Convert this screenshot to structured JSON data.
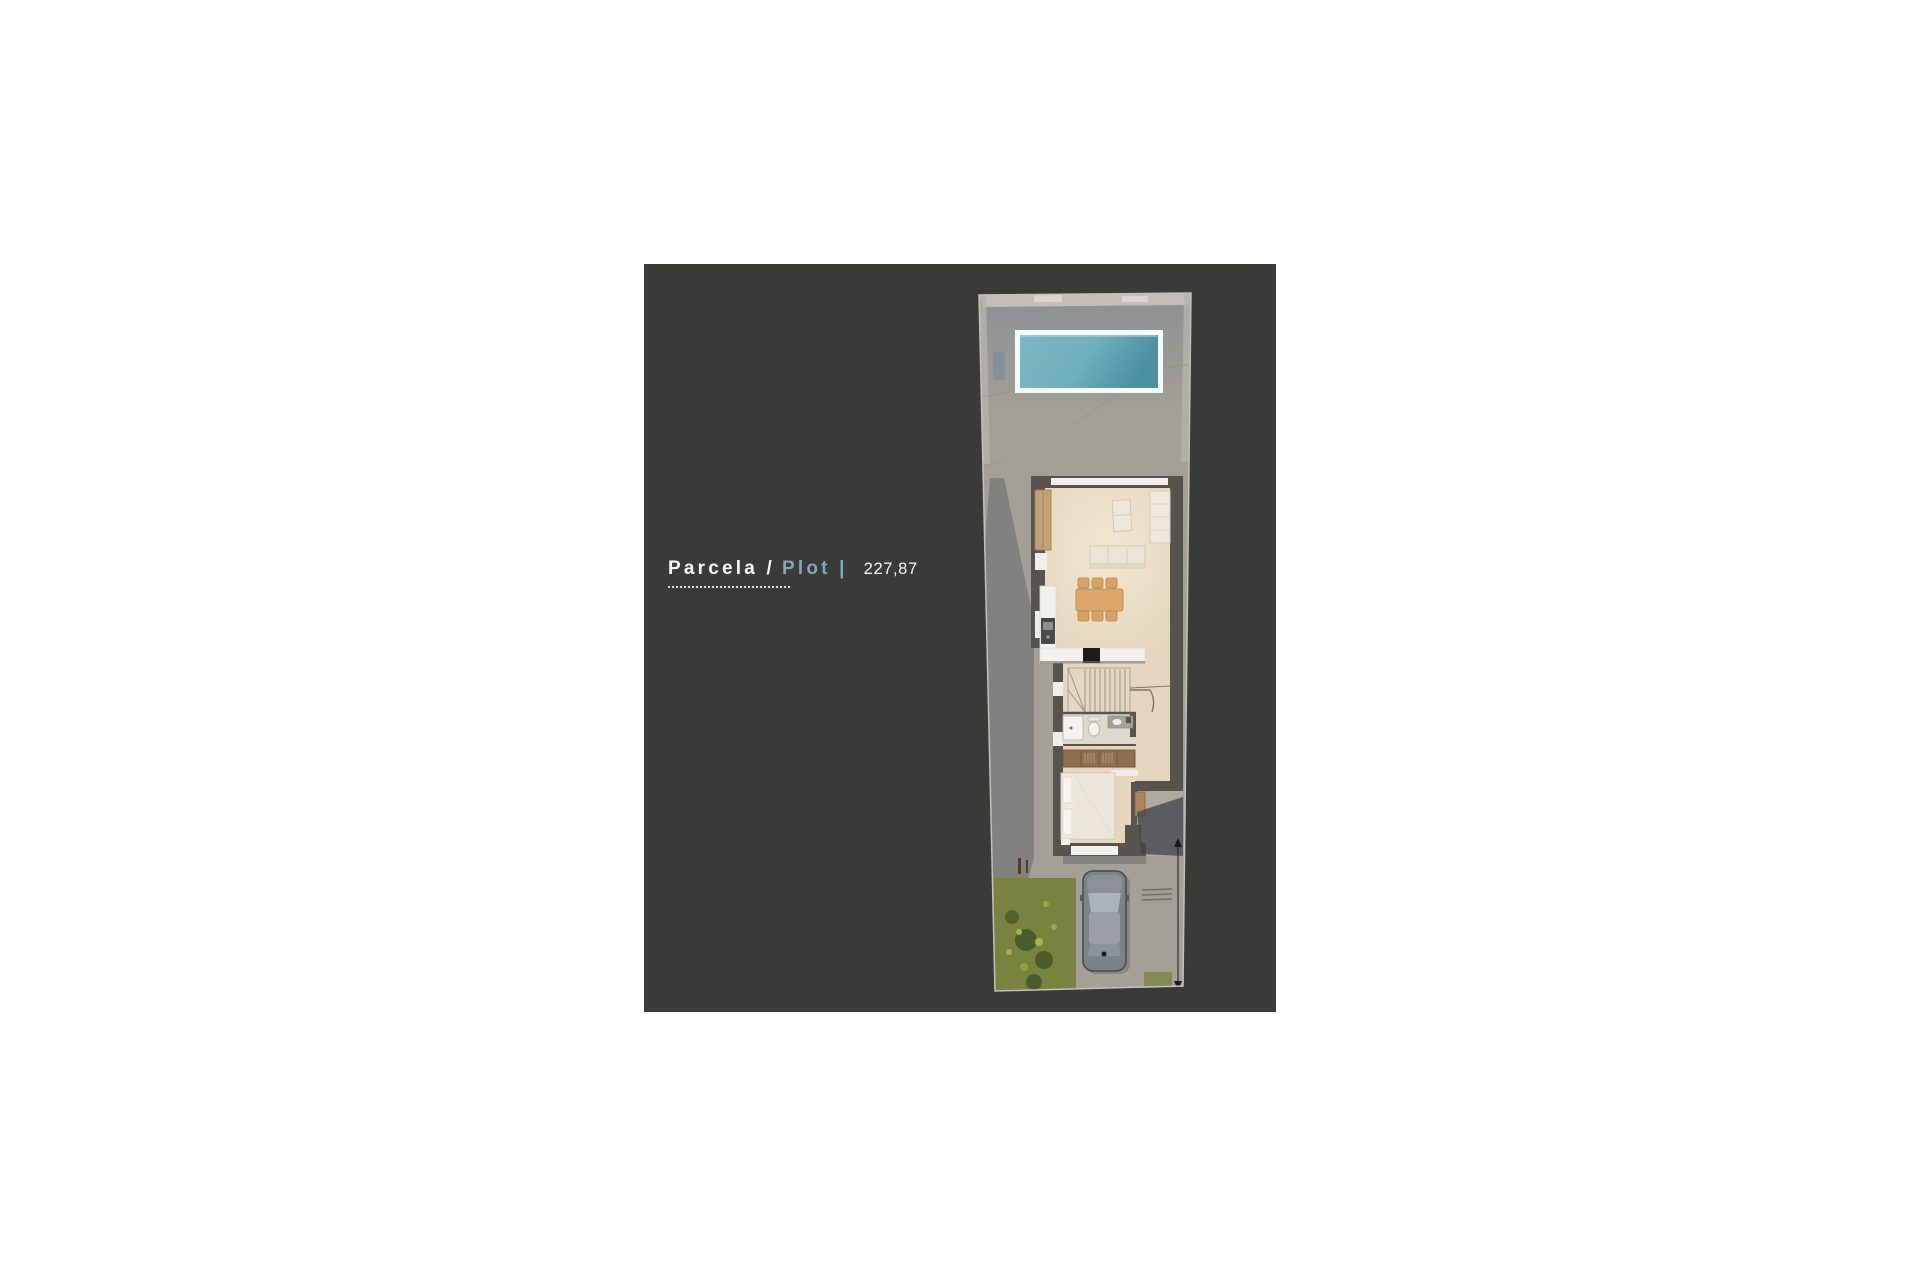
{
  "panel": {
    "background": "#3a3a38"
  },
  "label": {
    "primary": "Parcela /",
    "secondary": "Plot |",
    "value": "227,87"
  },
  "colors": {
    "page_bg": "#ffffff",
    "panel_bg": "#3a3a38",
    "text": "#f7f7f7",
    "accent_blue": "#7fa9bd",
    "dotted_line": "#d9d9d9",
    "ground_concrete": "#a49f97",
    "pool_water_light": "#7db7c4",
    "pool_water_dark": "#4b8fa2",
    "pool_frame": "#f4f9fa",
    "house_wall": "#57544f",
    "house_floor": "#e9dcc6",
    "wood_furniture": "#dba76c",
    "wardrobe_wood": "#8f6f4e",
    "grass_green": "#79823f",
    "car_body": "#7c8287"
  }
}
